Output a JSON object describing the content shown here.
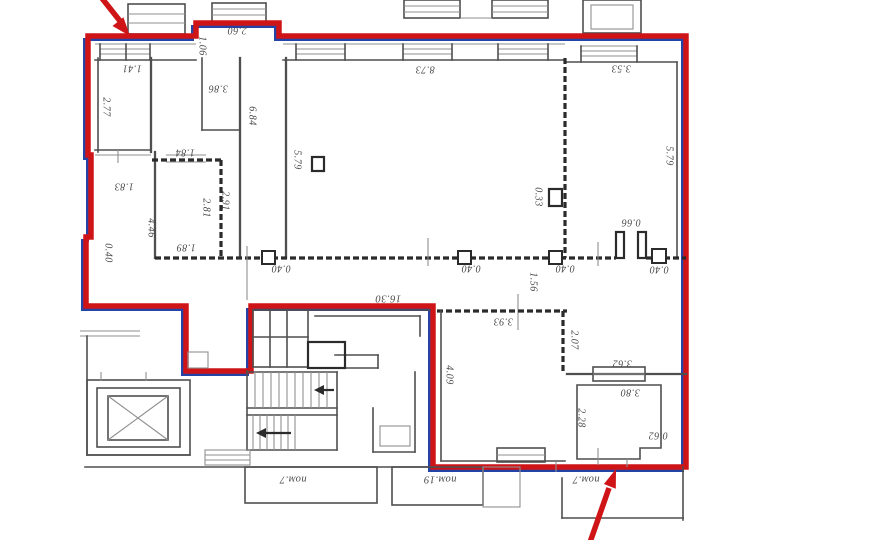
{
  "colors": {
    "outline_red": "#cf1418",
    "outline_blue": "#2343a6",
    "wall": "#4f4f4f",
    "wall_dark": "#2b2b2b",
    "wall_light": "#8f8f8f",
    "label_text": "#474747",
    "background": "#ffffff"
  },
  "plan": {
    "dims": {
      "d141": "1.41",
      "d277": "2.77",
      "d106": "1.06",
      "d260": "2.60",
      "d386": "3.86",
      "d684": "6.84",
      "d873": "8.73",
      "d353": "3.53",
      "d579a": "5.79",
      "d579b": "5.79",
      "d184": "1.84",
      "d183": "1.83",
      "d446": "4.46",
      "d281": "2.81",
      "d291": "2.91",
      "d189": "1.89",
      "d040l": "0.40",
      "d033": "0.33",
      "d066": "0.66",
      "d040a": "0.40",
      "d040b": "0.40",
      "d040c": "0.40",
      "d040d": "0.40",
      "d156": "1.56",
      "d1630": "16.30",
      "d393": "3.93",
      "d207": "2.07",
      "d409": "4.09",
      "d362": "3.62",
      "d380": "3.80",
      "d228": "2.28",
      "d062": "0.62"
    },
    "rooms": {
      "pom7a": "пом.7",
      "pom19": "пом.19",
      "pom7b": "пом.7"
    }
  }
}
